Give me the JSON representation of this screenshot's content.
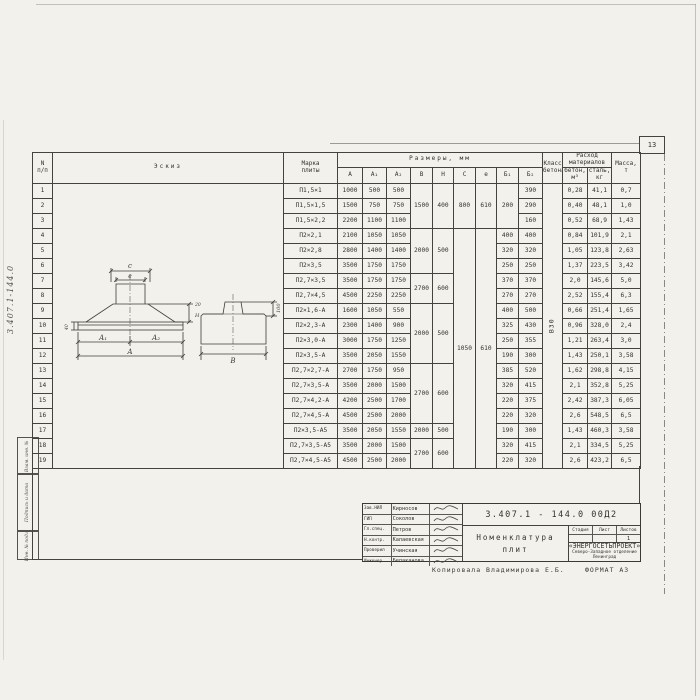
{
  "page_number": "13",
  "margin": {
    "doc_number_vertical": "3.407.1-144.0",
    "stamps": [
      "Взам. инв. №",
      "Подпись и дата",
      "Инв. № подл."
    ]
  },
  "table": {
    "headers": {
      "num_top": "N",
      "num_bottom": "п/п",
      "sketch": "Эскиз",
      "mark_l1": "Марка",
      "mark_l2": "плиты",
      "sizes": "Размеры, мм",
      "dims": [
        "А",
        "А₁",
        "А₂",
        "В",
        "Н",
        "С",
        "е",
        "Б₁",
        "Б₂"
      ],
      "cls_l1": "Класс",
      "cls_l2": "бетона",
      "consumption_l1": "Расход",
      "consumption_l2": "материалов",
      "concrete_l1": "бетон,",
      "concrete_l2": "м³",
      "steel_l1": "сталь,",
      "steel_l2": "кг",
      "mass_l1": "Масса,",
      "mass_l2": "т"
    },
    "rows": [
      {
        "n": "1",
        "mark": "П1,5×1",
        "a": "1000",
        "a1": "500",
        "a2": "500",
        "b": "1500",
        "b_rs": 3,
        "h": "400",
        "h_rs": 3,
        "c": "800",
        "c_rs": 3,
        "e": "610",
        "e_rs": 3,
        "b1": "200",
        "b1_rs": 3,
        "b2": "390",
        "cls": "В30",
        "cls_rs": 19,
        "conc": "0,28",
        "steel": "41,1",
        "mass": "0,7"
      },
      {
        "n": "2",
        "mark": "П1,5×1,5",
        "a": "1500",
        "a1": "750",
        "a2": "750",
        "b2": "290",
        "conc": "0,40",
        "steel": "48,1",
        "mass": "1,0"
      },
      {
        "n": "3",
        "mark": "П1,5×2,2",
        "a": "2200",
        "a1": "1100",
        "a2": "1100",
        "b2": "160",
        "conc": "0,52",
        "steel": "68,9",
        "mass": "1,43"
      },
      {
        "n": "4",
        "mark": "П2×2,1",
        "a": "2100",
        "a1": "1050",
        "a2": "1050",
        "b": "2000",
        "b_rs": 3,
        "h": "500",
        "h_rs": 3,
        "c": "1050",
        "c_rs": 16,
        "e": "610",
        "e_rs": 16,
        "b1": "400",
        "b2": "400",
        "conc": "0,84",
        "steel": "101,9",
        "mass": "2,1"
      },
      {
        "n": "5",
        "mark": "П2×2,8",
        "a": "2800",
        "a1": "1400",
        "a2": "1400",
        "b1": "320",
        "b2": "320",
        "conc": "1,05",
        "steel": "123,8",
        "mass": "2,63"
      },
      {
        "n": "6",
        "mark": "П2×3,5",
        "a": "3500",
        "a1": "1750",
        "a2": "1750",
        "b1": "250",
        "b2": "250",
        "conc": "1,37",
        "steel": "223,5",
        "mass": "3,42"
      },
      {
        "n": "7",
        "mark": "П2,7×3,5",
        "a": "3500",
        "a1": "1750",
        "a2": "1750",
        "b": "2700",
        "b_rs": 2,
        "h": "600",
        "h_rs": 2,
        "b1": "370",
        "b2": "370",
        "conc": "2,0",
        "steel": "145,6",
        "mass": "5,0"
      },
      {
        "n": "8",
        "mark": "П2,7×4,5",
        "a": "4500",
        "a1": "2250",
        "a2": "2250",
        "b1": "270",
        "b2": "270",
        "conc": "2,52",
        "steel": "155,4",
        "mass": "6,3"
      },
      {
        "n": "9",
        "mark": "П2×1,6-А",
        "a": "1600",
        "a1": "1050",
        "a2": "550",
        "b": "2000",
        "b_rs": 4,
        "h": "500",
        "h_rs": 4,
        "b1": "400",
        "b2": "500",
        "conc": "0,66",
        "steel": "251,4",
        "mass": "1,65"
      },
      {
        "n": "10",
        "mark": "П2×2,3-А",
        "a": "2300",
        "a1": "1400",
        "a2": "900",
        "b1": "325",
        "b2": "430",
        "conc": "0,96",
        "steel": "328,0",
        "mass": "2,4"
      },
      {
        "n": "11",
        "mark": "П2×3,0-А",
        "a": "3000",
        "a1": "1750",
        "a2": "1250",
        "b1": "250",
        "b2": "355",
        "conc": "1,21",
        "steel": "263,4",
        "mass": "3,0"
      },
      {
        "n": "12",
        "mark": "П2×3,5-А",
        "a": "3500",
        "a1": "2050",
        "a2": "1550",
        "b1": "190",
        "b2": "300",
        "conc": "1,43",
        "steel": "250,1",
        "mass": "3,58"
      },
      {
        "n": "13",
        "mark": "П2,7×2,7-А",
        "a": "2700",
        "a1": "1750",
        "a2": "950",
        "b": "2700",
        "b_rs": 4,
        "h": "600",
        "h_rs": 4,
        "b1": "385",
        "b2": "520",
        "conc": "1,62",
        "steel": "298,8",
        "mass": "4,15"
      },
      {
        "n": "14",
        "mark": "П2,7×3,5-А",
        "a": "3500",
        "a1": "2000",
        "a2": "1500",
        "b1": "320",
        "b2": "415",
        "conc": "2,1",
        "steel": "352,8",
        "mass": "5,25"
      },
      {
        "n": "15",
        "mark": "П2,7×4,2-А",
        "a": "4200",
        "a1": "2500",
        "a2": "1700",
        "b1": "220",
        "b2": "375",
        "conc": "2,42",
        "steel": "387,3",
        "mass": "6,05"
      },
      {
        "n": "16",
        "mark": "П2,7×4,5-А",
        "a": "4500",
        "a1": "2500",
        "a2": "2000",
        "b1": "220",
        "b2": "320",
        "conc": "2,6",
        "steel": "548,5",
        "mass": "6,5"
      },
      {
        "n": "17",
        "mark": "П2×3,5-А5",
        "a": "3500",
        "a1": "2050",
        "a2": "1550",
        "b": "2000",
        "b_rs": 1,
        "h": "500",
        "h_rs": 1,
        "b1": "190",
        "b2": "300",
        "conc": "1,43",
        "steel": "460,3",
        "mass": "3,58"
      },
      {
        "n": "18",
        "mark": "П2,7×3,5-А5",
        "a": "3500",
        "a1": "2000",
        "a2": "1500",
        "b": "2700",
        "b_rs": 2,
        "h": "600",
        "h_rs": 2,
        "b1": "320",
        "b2": "415",
        "conc": "2,1",
        "steel": "334,5",
        "mass": "5,25"
      },
      {
        "n": "19",
        "mark": "П2,7×4,5-А5",
        "a": "4500",
        "a1": "2500",
        "a2": "2000",
        "b1": "220",
        "b2": "320",
        "conc": "2,6",
        "steel": "423,2",
        "mass": "6,5"
      }
    ]
  },
  "sketch": {
    "c": "c",
    "e": "e",
    "a1": "А₁",
    "a2": "А₂",
    "a": "А",
    "b": "В",
    "h_right": "Н",
    "lip": "20",
    "plate_edge": "40",
    "boss_height": "100"
  },
  "title_block": {
    "doc_number": "3.407.1 - 144.0  00Д2",
    "title_l1": "Номенклатура",
    "title_l2": "плит",
    "stage_cols": [
      "Стадия",
      "Лист",
      "Листов"
    ],
    "sheets_value": "1",
    "org_name": "«ЭНЕРГОСЕТЬПРОЕКТ»",
    "org_branch": "Северо-Западное отделение",
    "org_city": "Ленинград",
    "signatures": [
      {
        "role": "Зав.НИЛ",
        "name": "Кирносов"
      },
      {
        "role": "ГИП",
        "name": "Соколов"
      },
      {
        "role": "Гл.спец.",
        "name": "Петров"
      },
      {
        "role": "Н.контр.",
        "name": "Калаевская"
      },
      {
        "role": "Проверил",
        "name": "Учинская"
      },
      {
        "role": "Инженер",
        "name": "Белаканова"
      }
    ]
  },
  "footer": {
    "copied_by": "Копировала Владимирова Е.Б.",
    "format": "ФОРМАТ А3"
  }
}
